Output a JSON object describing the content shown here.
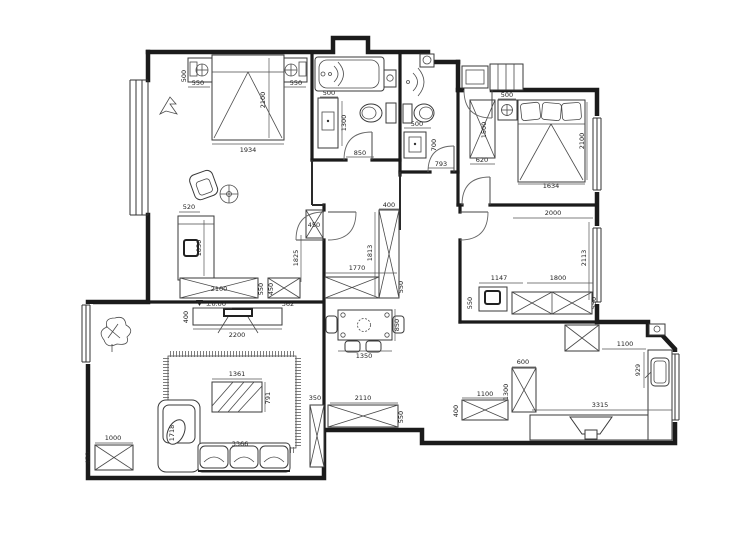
{
  "dims": {
    "ms": {
      "ns_left_d": "500",
      "ns_left_w": "550",
      "ns_right_w": "550",
      "bed_d": "2100",
      "bed_w": "1934"
    },
    "dr": {
      "bed_head": "520",
      "bed_len": "1850",
      "wall": "1825",
      "wardrobe_w": "2100",
      "wardrobe_d": "550",
      "cab_d": "450",
      "cab_w": "362"
    },
    "b1": {
      "vanity_w": "500",
      "vanity_d": "1300",
      "door": "850"
    },
    "b2": {
      "fixture": "500",
      "vanity_d": "700",
      "door": "793"
    },
    "br2": {
      "ns": "500",
      "wardrobe_len": "1500",
      "wardrobe_w": "620",
      "bed_d": "2100",
      "bed_w": "1634"
    },
    "br3": {
      "bed_w": "2000",
      "bed_d": "2113",
      "desk": "1147",
      "cabinet": "1800",
      "closet_l": "550",
      "closet_r": "550"
    },
    "hall": {
      "cab_w": "400",
      "cab_h": "1813",
      "cab_len": "1770",
      "cab_d": "550",
      "cab_small": "450"
    },
    "dining": {
      "table_w": "1350",
      "table_d": "850"
    },
    "living": {
      "level": "±0.00",
      "tv_d": "400",
      "tv_w": "2200",
      "table_w": "1361",
      "table_d": "791",
      "sofa_d": "1718",
      "sofa_w": "3366",
      "shoe_w": "1000",
      "shoe_d": "450",
      "side_cab": "350",
      "row_cab": "2110",
      "row_d": "550"
    },
    "kitchen": {
      "cab_w": "1100",
      "cab_d": "400",
      "cab_h": "1300",
      "tall_cab": "600",
      "counter_top": "1100",
      "counter_side": "929",
      "counter": "3315"
    }
  }
}
